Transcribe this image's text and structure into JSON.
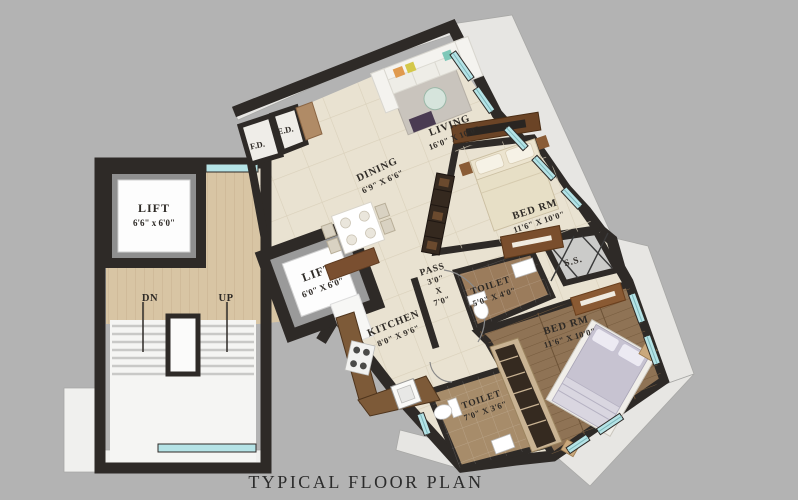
{
  "title": "TYPICAL FLOOR PLAN",
  "colors": {
    "background": "#b3b3b3",
    "wall": "#2e2a27",
    "floor_tile": "#e9e2d1",
    "lobby_wood": "#d8c5a4",
    "bedroom_wood": "#8f7355",
    "window_glass": "#b5e3e6",
    "chajja_slab": "#e7e6e3",
    "counter_marble": "#7d5a38"
  },
  "rooms": {
    "lift_main": {
      "label": "LIFT",
      "dims": "6'6\" x 6'0\""
    },
    "lift_secondary": {
      "label": "LIFT",
      "dims": "6'0\" X 6'0\""
    },
    "dining": {
      "label": "DINING",
      "dims": "6'9\" X 6'6\""
    },
    "living": {
      "label": "LIVING",
      "dims": "16'0\" X 10'0\""
    },
    "bedroom_top": {
      "label": "BED RM",
      "dims": "11'6\" X 10'0\""
    },
    "pass": {
      "label": "PASS",
      "dim_w": "3'0\"",
      "dim_sep": "X",
      "dim_h": "7'0\""
    },
    "toilet_top": {
      "label": "TOILET",
      "dims": "5'0\" X 4'0\""
    },
    "service_slab": {
      "label": "S.S."
    },
    "kitchen": {
      "label": "KITCHEN",
      "dims": "8'0\" X 9'6\""
    },
    "bedroom_bottom": {
      "label": "BED RM",
      "dims": "11'6\" X 10'0\""
    },
    "toilet_bottom": {
      "label": "TOILET",
      "dims": "7'0\" X 3'6\""
    },
    "fire_duct": {
      "label": "F.D."
    },
    "electrical_duct": {
      "label": "E.D."
    }
  },
  "stairs": {
    "down": "DN",
    "up": "UP"
  }
}
